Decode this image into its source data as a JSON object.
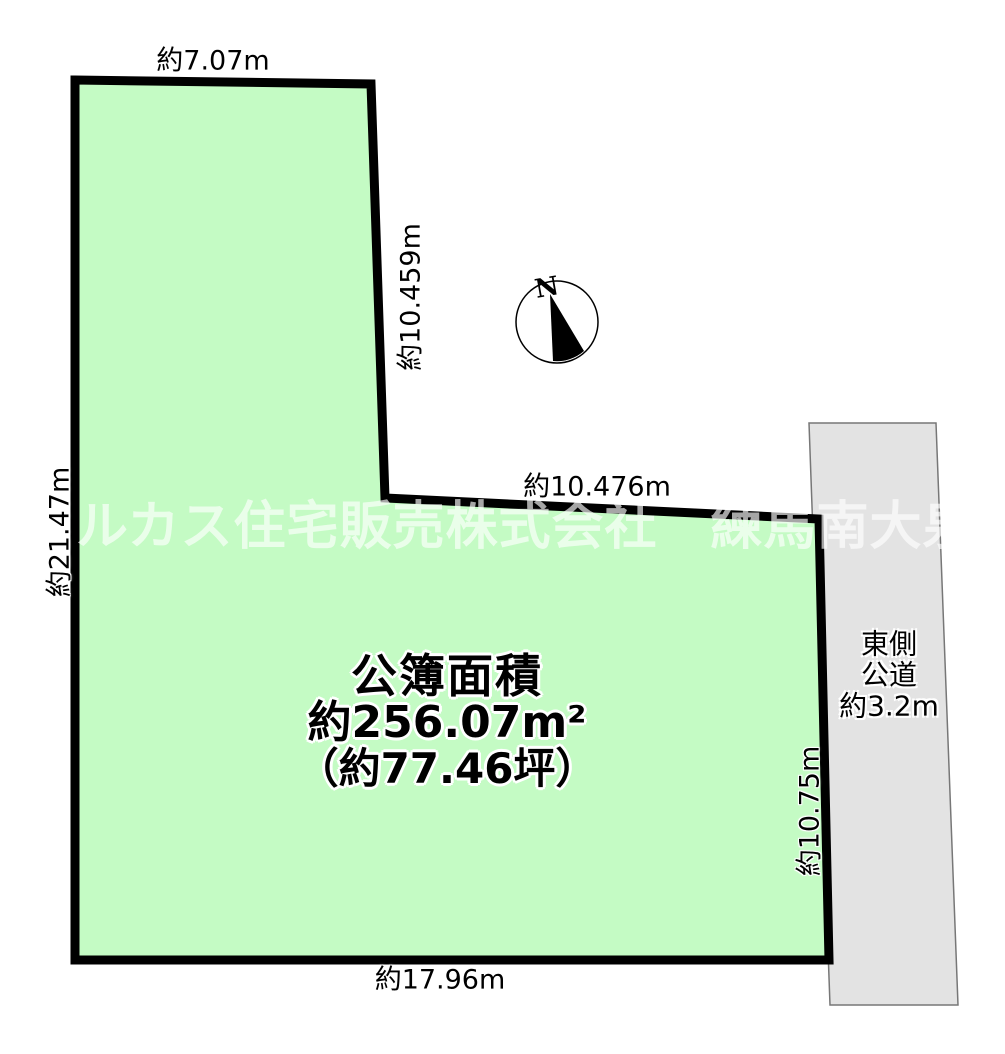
{
  "diagram": {
    "type": "land-plot-site-plan",
    "dimensions": {
      "top": "約7.07m",
      "upper_right": "約10.459m",
      "middle": "約10.476m",
      "left": "約21.47m",
      "lower_right": "約10.75m",
      "bottom": "約17.96m"
    },
    "area_label": {
      "line1": "公簿面積",
      "line2": "約256.07m²",
      "line3": "（約77.46坪）"
    },
    "road_label": {
      "line1": "東側",
      "line2": "公道",
      "line3": "約3.2m"
    },
    "compass": {
      "north_label": "N"
    },
    "watermark": "ルカス住宅販売株式会社　練馬南大泉",
    "colors": {
      "plot_fill": "#c4fbc4",
      "plot_border": "#000000",
      "road_fill": "#e3e3e3",
      "road_border": "#777777",
      "background": "#ffffff",
      "text": "#000000",
      "watermark": "rgba(255,255,255,0.65)"
    }
  }
}
